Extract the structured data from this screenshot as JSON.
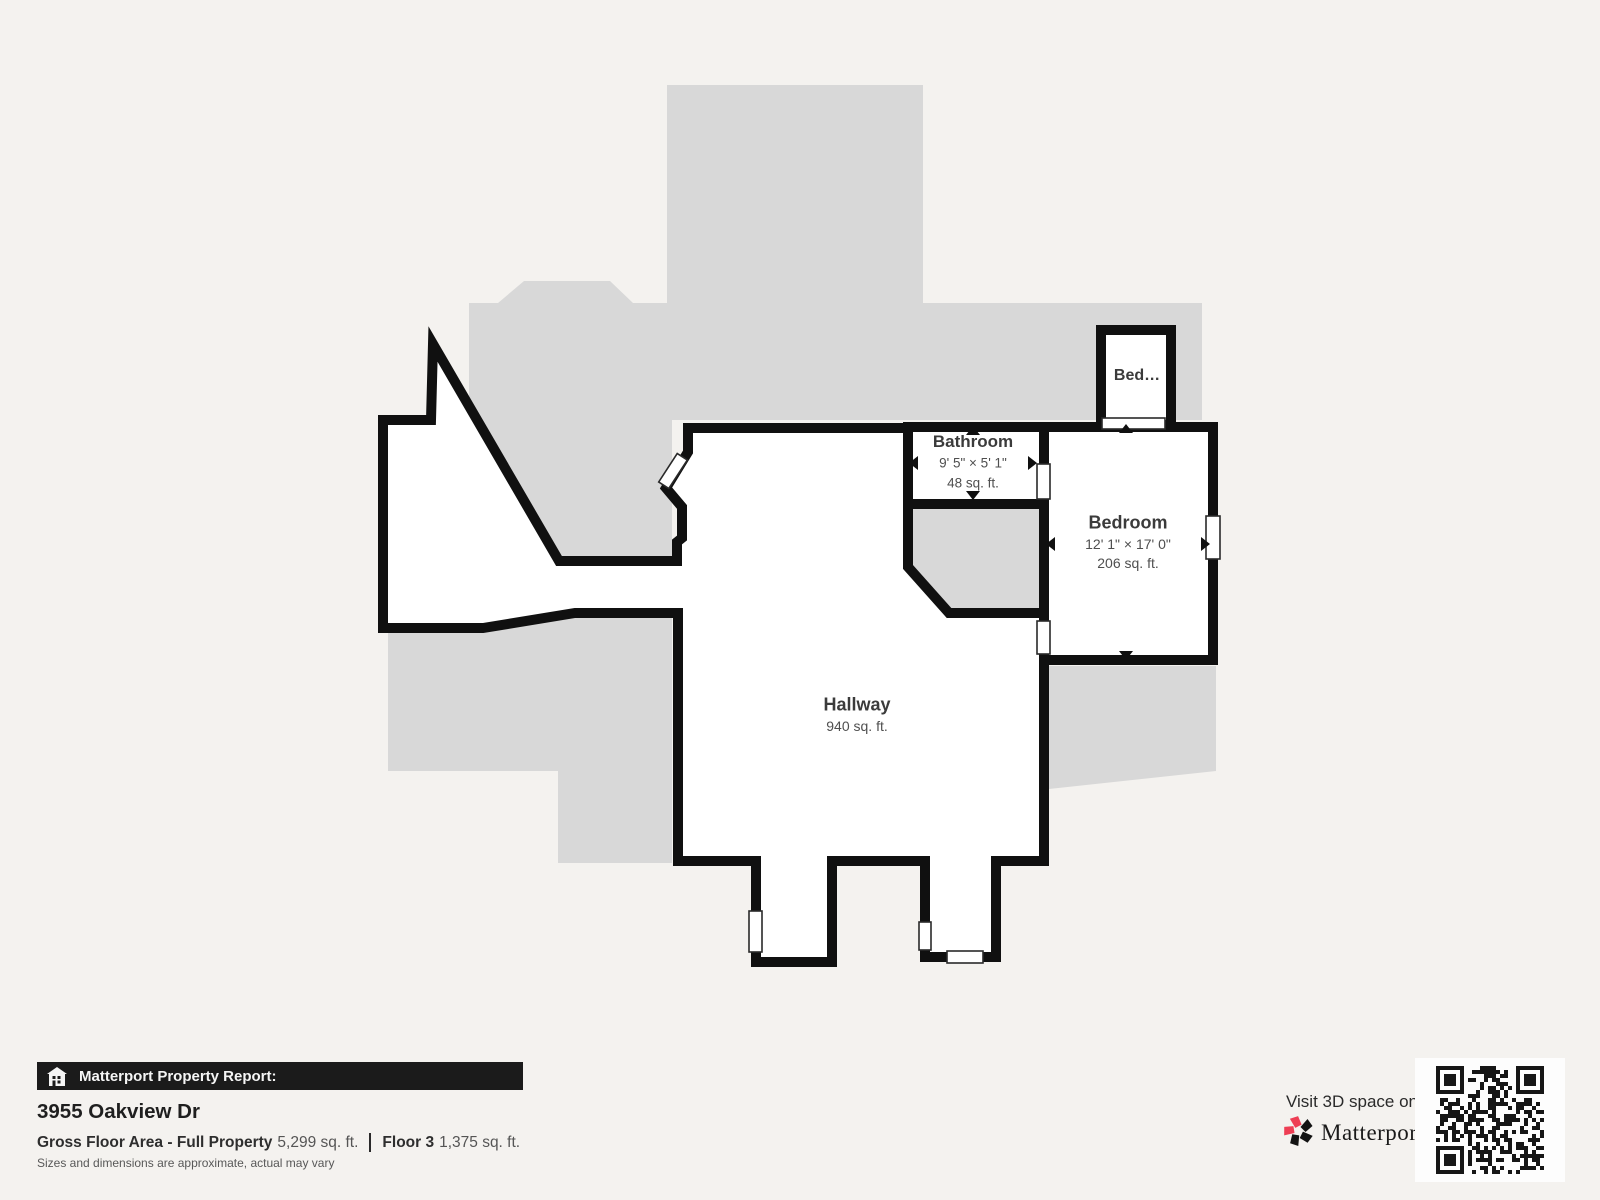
{
  "floor_plan": {
    "rooms": {
      "bathroom": {
        "name": "Bathroom",
        "dimensions": "9' 5\" × 5' 1\"",
        "area": "48 sq. ft."
      },
      "bedroom": {
        "name": "Bedroom",
        "dimensions": "12' 1\" × 17' 0\"",
        "area": "206 sq. ft."
      },
      "hallway": {
        "name": "Hallway",
        "area": "940 sq. ft."
      },
      "small_bedroom": {
        "name": "Bed…"
      }
    },
    "colors": {
      "wall": "#101010",
      "silhouette": "#d8d8d8",
      "room_fill": "#ffffff",
      "background": "#f4f2ef"
    }
  },
  "footer": {
    "report_bar": {
      "label": "Matterport Property Report:"
    },
    "address": "3955 Oakview Dr",
    "stats": {
      "gross_label": "Gross Floor Area - Full Property",
      "gross_value": "5,299 sq. ft.",
      "floor_label": "Floor 3",
      "floor_value": "1,375 sq. ft."
    },
    "disclaimer": "Sizes and dimensions are approximate, actual may vary",
    "cta": {
      "visit_text": "Visit 3D space on",
      "brand": "Matterport"
    }
  }
}
